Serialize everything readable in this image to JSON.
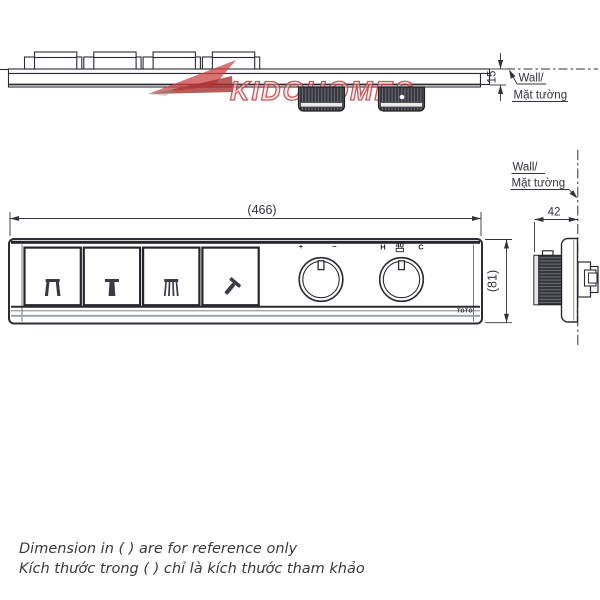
{
  "drawing": {
    "line_color": "#2c2c34",
    "accent_red": "#c5393c"
  },
  "watermark": {
    "brand": "KIDOHOMES"
  },
  "top_view": {
    "offset_dim": "15",
    "wall_label": {
      "line1": "Wall/",
      "line2": "Mặt tường"
    }
  },
  "front_view": {
    "width_dim": "(466)",
    "height_dim": "(81)",
    "buttons": [
      {
        "icon": "overhead-dual-spray"
      },
      {
        "icon": "single-spray"
      },
      {
        "icon": "wide-spray"
      },
      {
        "icon": "hand-shower"
      }
    ],
    "volume_knob": {
      "plus": "+",
      "minus": "−"
    },
    "temp_knob": {
      "hot": "H",
      "safety_stop": "40",
      "cold": "C"
    },
    "brand_logo": "TOTO"
  },
  "side_view": {
    "depth_dim": "42",
    "wall_label": {
      "line1": "Wall/",
      "line2": "Mặt tường"
    }
  },
  "footer": {
    "note_en": "Dimension in ( ) are for reference only",
    "note_vi": "Kích thước trong ( ) chỉ là kích thước tham khảo"
  }
}
